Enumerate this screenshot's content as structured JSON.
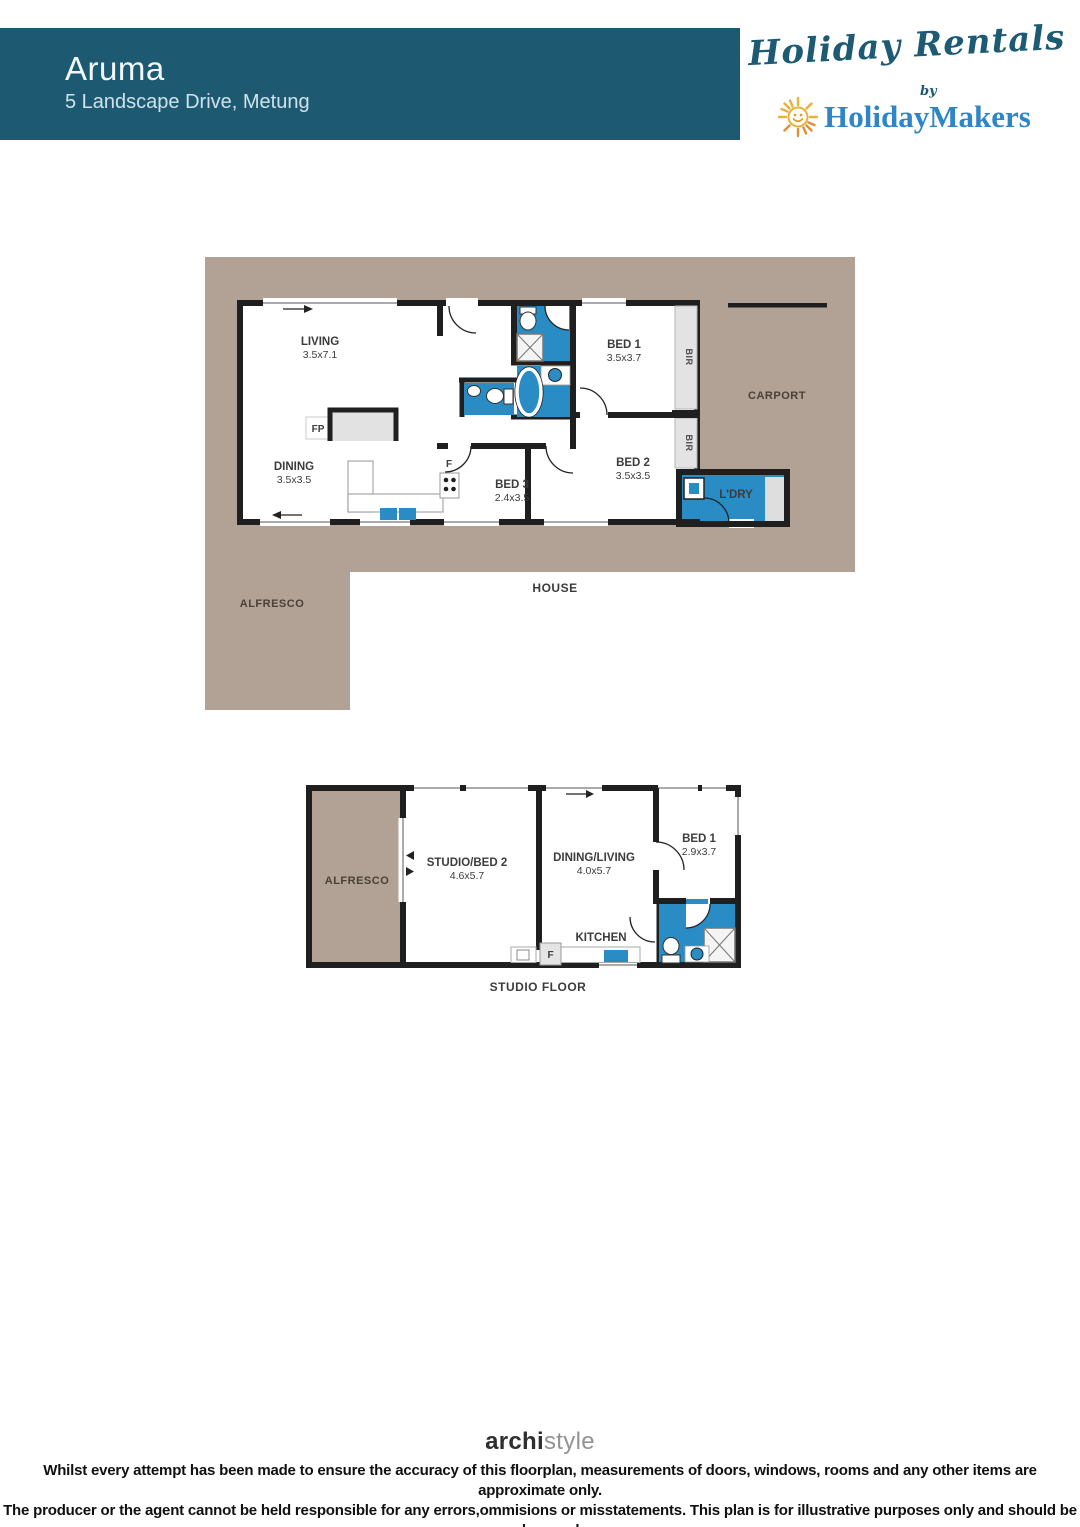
{
  "header": {
    "title": "Aruma",
    "address": "5 Landscape Drive, Metung"
  },
  "brand": {
    "script": "Holiday Rentals",
    "by": "by",
    "name": "HolidayMakers",
    "sun_icon": "sun-smiley-icon"
  },
  "house_plan": {
    "caption": "HOUSE",
    "carport": "CARPORT",
    "alfresco": "ALFRESCO",
    "living": {
      "label": "LIVING",
      "dims": "3.5x7.1"
    },
    "dining": {
      "label": "DINING",
      "dims": "3.5x3.5"
    },
    "bed1": {
      "label": "BED 1",
      "dims": "3.5x3.7"
    },
    "bed2": {
      "label": "BED 2",
      "dims": "3.5x3.5"
    },
    "bed3": {
      "label": "BED 3",
      "dims": "2.4x3.5"
    },
    "laundry": "L'DRY",
    "bir": "BIR",
    "fireplace": "FP",
    "fridge": "F"
  },
  "studio_plan": {
    "caption": "STUDIO FLOOR",
    "alfresco": "ALFRESCO",
    "studio_bed2": {
      "label": "STUDIO/BED 2",
      "dims": "4.6x5.7"
    },
    "dining_living": {
      "label": "DINING/LIVING",
      "dims": "4.0x5.7"
    },
    "bed1": {
      "label": "BED 1",
      "dims": "2.9x3.7"
    },
    "kitchen": "KITCHEN",
    "fridge": "F"
  },
  "footer": {
    "logo_a": "archi",
    "logo_b": "style",
    "disclaimer1": "Whilst every attempt has been made to ensure the accuracy of this floorplan, measurements of doors, windows, rooms and any other items are approximate only.",
    "disclaimer2": "The producer or the agent cannot be held responsible for any errors,ommisions or misstatements. This plan is for illustrative purposes only and should be used as such."
  },
  "colors": {
    "header_teal": "#1d5a72",
    "brand_blue": "#2e86c8",
    "plan_blue": "#2a8cc4",
    "taupe": "#b2a296",
    "wall_black": "#1f1f1f",
    "sun_gold": "#e6b23a",
    "sun_orange": "#dd8f3c"
  }
}
